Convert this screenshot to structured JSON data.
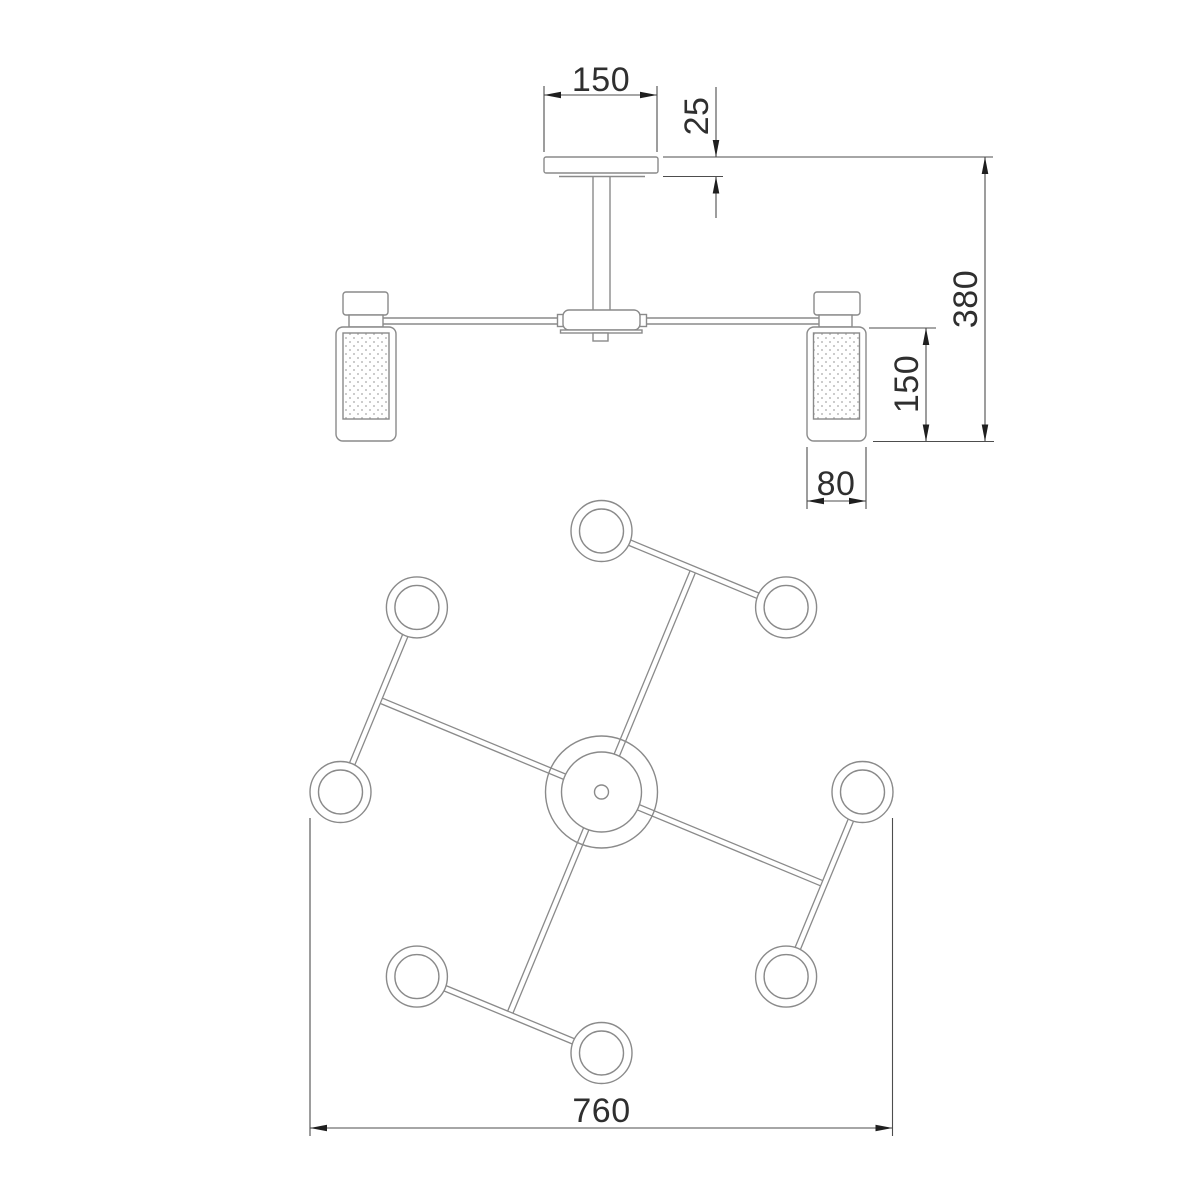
{
  "drawing": {
    "dims": {
      "canopy_width": "150",
      "canopy_height": "25",
      "overall_height": "380",
      "shade_height": "150",
      "shade_width": "80",
      "overall_width": "760"
    },
    "colors": {
      "bg": "#ffffff",
      "outline": "#8a8a8a",
      "dim": "#4d4d4d",
      "text": "#2f2f2f",
      "arrow": "#1f1f1f",
      "dots": "#bcbcbc"
    }
  }
}
